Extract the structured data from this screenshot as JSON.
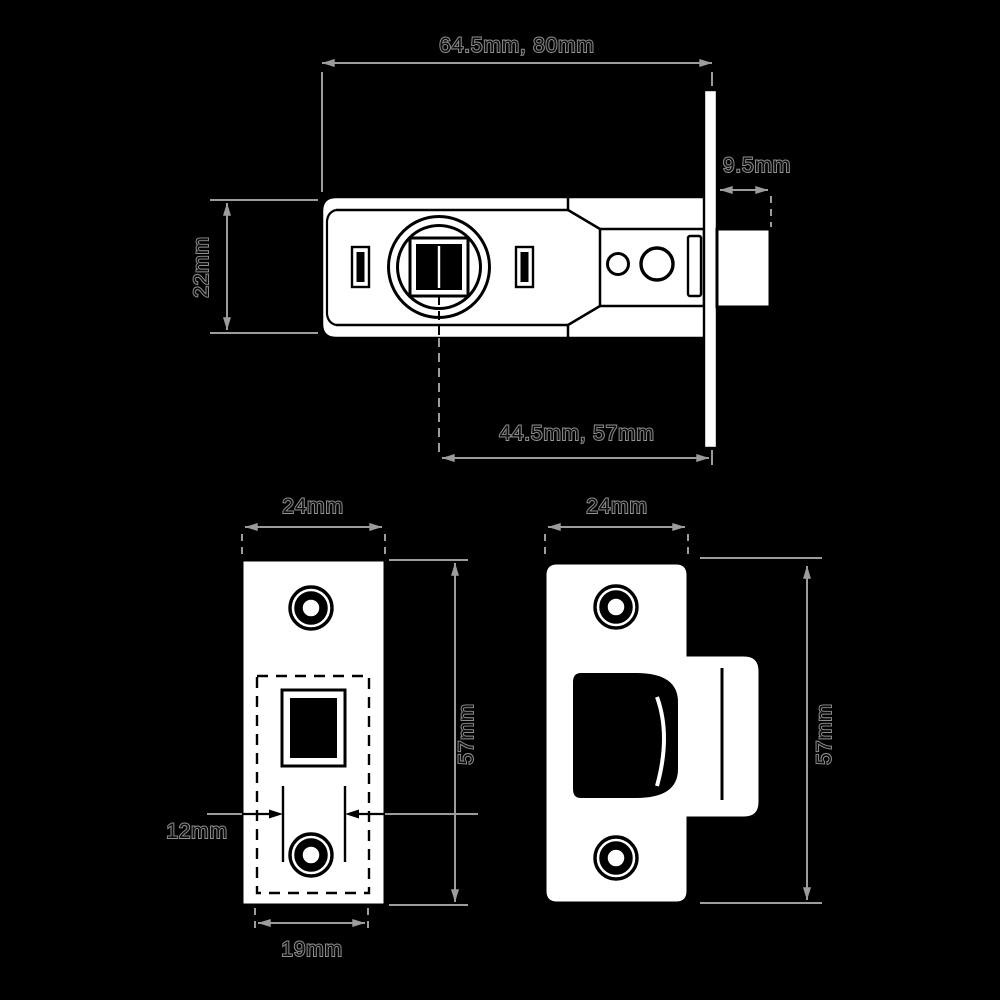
{
  "title": "Tubular mortice latch dimension drawing",
  "colors": {
    "background": "#000000",
    "shape_fill": "#ffffff",
    "detail_line": "#000000",
    "dimension_line": "#9c9c9c"
  },
  "views": {
    "side": {
      "label": "latch side view",
      "dims": {
        "overall_length": "64.5mm, 80mm",
        "bolt_projection": "9.5mm",
        "case_height": "22mm",
        "backset": "44.5mm, 57mm"
      }
    },
    "faceplate": {
      "label": "faceplate front view",
      "dims": {
        "width": "24mm",
        "height": "57mm",
        "follower_width": "12mm",
        "case_width": "19mm"
      }
    },
    "strike": {
      "label": "strike plate view",
      "dims": {
        "width": "24mm",
        "height": "57mm"
      }
    }
  }
}
